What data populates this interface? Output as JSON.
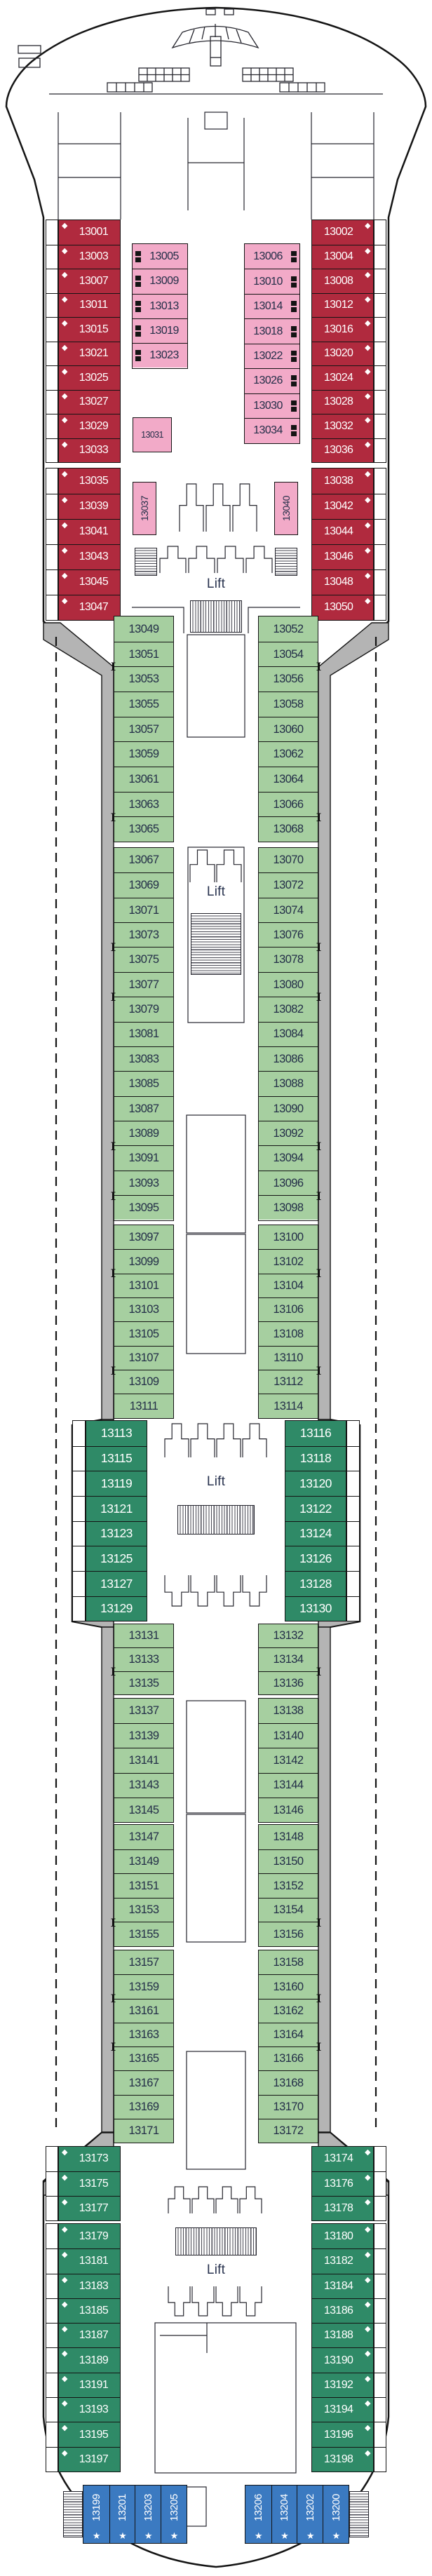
{
  "deck_plan": {
    "lifts": [
      "Lift",
      "Lift",
      "Lift",
      "Lift"
    ],
    "colors": {
      "suite_red": "#b02a3e",
      "interior_pink": "#f2aac8",
      "balcony_green": "#a6cfa0",
      "premium_teal": "#2f8a67",
      "family_blue": "#3b7ac1",
      "hull_gray": "#b4b4b4",
      "outline_black": "#141414",
      "dark_text": "#232e48",
      "light_text": "#ffffff"
    },
    "cabin_categories": {
      "suite": {
        "color": "#b02a3e",
        "text": "#ffffff",
        "symbol": "diamond"
      },
      "interior": {
        "color": "#f2aac8",
        "text": "#232e48",
        "symbol": "bunk"
      },
      "balcony": {
        "color": "#a6cfa0",
        "text": "#232e48",
        "symbol": null
      },
      "premium_balcony": {
        "color": "#2f8a67",
        "text": "#ffffff",
        "symbol": null
      },
      "aft_suite": {
        "color": "#2f8a67",
        "text": "#ffffff",
        "symbol": "diamond"
      },
      "family_suite": {
        "color": "#3b7ac1",
        "text": "#ffffff",
        "symbol": "star"
      }
    },
    "symbols_legend": {
      "diamond": "suite grade marker",
      "bunk": "upper berths available",
      "star": "aft family suite marker",
      "connector": "connecting staterooms"
    },
    "groups": [
      {
        "id": "fwd-port-suites-a",
        "category": "suite",
        "symbol_side": "left",
        "cabins": [
          "13001",
          "13003",
          "13007",
          "13011",
          "13015",
          "13021",
          "13025",
          "13027",
          "13029",
          "13033"
        ]
      },
      {
        "id": "fwd-port-suites-b",
        "category": "suite",
        "symbol_side": "left",
        "cabins": [
          "13035",
          "13039",
          "13041",
          "13043",
          "13045",
          "13047"
        ]
      },
      {
        "id": "fwd-stbd-suites-a",
        "category": "suite",
        "symbol_side": "right",
        "cabins": [
          "13002",
          "13004",
          "13008",
          "13012",
          "13016",
          "13020",
          "13024",
          "13028",
          "13032",
          "13036"
        ]
      },
      {
        "id": "fwd-stbd-suites-b",
        "category": "suite",
        "symbol_side": "right",
        "cabins": [
          "13038",
          "13042",
          "13044",
          "13046",
          "13048",
          "13050"
        ]
      },
      {
        "id": "fwd-port-interior",
        "category": "interior",
        "symbol_side": "left",
        "cabins": [
          "13005",
          "13009",
          "13013",
          "13019",
          "13023"
        ]
      },
      {
        "id": "fwd-stbd-interior",
        "category": "interior",
        "symbol_side": "right",
        "cabins": [
          "13006",
          "13010",
          "13014",
          "13018",
          "13022",
          "13026",
          "13030",
          "13034"
        ]
      },
      {
        "id": "fwd-interior-single",
        "category": "interior",
        "symbol": "none",
        "cabins": [
          "13031"
        ]
      },
      {
        "id": "fwd-port-interior-vertical",
        "category": "interior",
        "symbol": "none",
        "cabins": [
          "13037"
        ]
      },
      {
        "id": "fwd-stbd-interior-vertical",
        "category": "interior",
        "symbol": "none",
        "cabins": [
          "13040"
        ]
      },
      {
        "id": "mid-port-balcony-1",
        "category": "balcony",
        "cabins": [
          "13049",
          "13051",
          "13053",
          "13055",
          "13057",
          "13059",
          "13061",
          "13063",
          "13065"
        ],
        "connect_after": [
          "13051",
          "13063"
        ]
      },
      {
        "id": "mid-port-balcony-2",
        "category": "balcony",
        "cabins": [
          "13067",
          "13069",
          "13071",
          "13073",
          "13075",
          "13077",
          "13079",
          "13081",
          "13083",
          "13085",
          "13087",
          "13089",
          "13091",
          "13093",
          "13095"
        ],
        "connect_after": [
          "13073",
          "13077",
          "13089",
          "13093"
        ]
      },
      {
        "id": "mid-port-balcony-3",
        "category": "balcony",
        "cabins": [
          "13097",
          "13099",
          "13101",
          "13103",
          "13105",
          "13107",
          "13109",
          "13111"
        ],
        "connect_after": [
          "13099",
          "13107"
        ]
      },
      {
        "id": "mid-port-premium",
        "category": "premium_balcony",
        "cabins": [
          "13113",
          "13115",
          "13119",
          "13121",
          "13123",
          "13125",
          "13127",
          "13129"
        ]
      },
      {
        "id": "mid-port-balcony-4",
        "category": "balcony",
        "cabins": [
          "13131",
          "13133",
          "13135"
        ],
        "connect_after": [
          "13133"
        ]
      },
      {
        "id": "mid-port-balcony-5",
        "category": "balcony",
        "cabins": [
          "13137",
          "13139",
          "13141",
          "13143",
          "13145"
        ]
      },
      {
        "id": "mid-port-balcony-6",
        "category": "balcony",
        "cabins": [
          "13147",
          "13149",
          "13151",
          "13153",
          "13155"
        ],
        "connect_after": [
          "13153"
        ]
      },
      {
        "id": "mid-port-balcony-7",
        "category": "balcony",
        "cabins": [
          "13157",
          "13159",
          "13161",
          "13163",
          "13165",
          "13167",
          "13169",
          "13171"
        ],
        "connect_after": [
          "13159",
          "13163"
        ]
      },
      {
        "id": "mid-stbd-balcony-1",
        "category": "balcony",
        "cabins": [
          "13052",
          "13054",
          "13056",
          "13058",
          "13060",
          "13062",
          "13064",
          "13066",
          "13068"
        ],
        "connect_after": [
          "13054",
          "13066"
        ]
      },
      {
        "id": "mid-stbd-balcony-2",
        "category": "balcony",
        "cabins": [
          "13070",
          "13072",
          "13074",
          "13076",
          "13078",
          "13080",
          "13082",
          "13084",
          "13086",
          "13088",
          "13090",
          "13092",
          "13094",
          "13096",
          "13098"
        ],
        "connect_after": [
          "13076",
          "13080",
          "13092",
          "13096"
        ]
      },
      {
        "id": "mid-stbd-balcony-3",
        "category": "balcony",
        "cabins": [
          "13100",
          "13102",
          "13104",
          "13106",
          "13108",
          "13110",
          "13112",
          "13114"
        ],
        "connect_after": [
          "13102",
          "13110"
        ]
      },
      {
        "id": "mid-stbd-premium",
        "category": "premium_balcony",
        "cabins": [
          "13116",
          "13118",
          "13120",
          "13122",
          "13124",
          "13126",
          "13128",
          "13130"
        ]
      },
      {
        "id": "mid-stbd-balcony-4",
        "category": "balcony",
        "cabins": [
          "13132",
          "13134",
          "13136"
        ],
        "connect_after": [
          "13134"
        ]
      },
      {
        "id": "mid-stbd-balcony-5",
        "category": "balcony",
        "cabins": [
          "13138",
          "13140",
          "13142",
          "13144",
          "13146"
        ]
      },
      {
        "id": "mid-stbd-balcony-6",
        "category": "balcony",
        "cabins": [
          "13148",
          "13150",
          "13152",
          "13154",
          "13156"
        ],
        "connect_after": [
          "13154"
        ]
      },
      {
        "id": "mid-stbd-balcony-7",
        "category": "balcony",
        "cabins": [
          "13158",
          "13160",
          "13162",
          "13164",
          "13166",
          "13168",
          "13170",
          "13172"
        ],
        "connect_after": [
          "13160",
          "13164"
        ]
      },
      {
        "id": "aft-port-suites-a",
        "category": "aft_suite",
        "symbol_side": "left",
        "cabins": [
          "13173",
          "13175",
          "13177"
        ]
      },
      {
        "id": "aft-port-suites-b",
        "category": "aft_suite",
        "symbol_side": "left",
        "cabins": [
          "13179",
          "13181",
          "13183",
          "13185",
          "13187",
          "13189",
          "13191",
          "13193",
          "13195",
          "13197"
        ]
      },
      {
        "id": "aft-stbd-suites-a",
        "category": "aft_suite",
        "symbol_side": "right",
        "cabins": [
          "13174",
          "13176",
          "13178"
        ]
      },
      {
        "id": "aft-stbd-suites-b",
        "category": "aft_suite",
        "symbol_side": "right",
        "cabins": [
          "13180",
          "13182",
          "13184",
          "13186",
          "13188",
          "13190",
          "13192",
          "13194",
          "13196",
          "13198"
        ]
      },
      {
        "id": "aft-port-family",
        "category": "family_suite",
        "cabins": [
          "13199",
          "13201",
          "13203",
          "13205"
        ]
      },
      {
        "id": "aft-stbd-family",
        "category": "family_suite",
        "cabins": [
          "13206",
          "13204",
          "13202",
          "13200"
        ]
      }
    ]
  }
}
